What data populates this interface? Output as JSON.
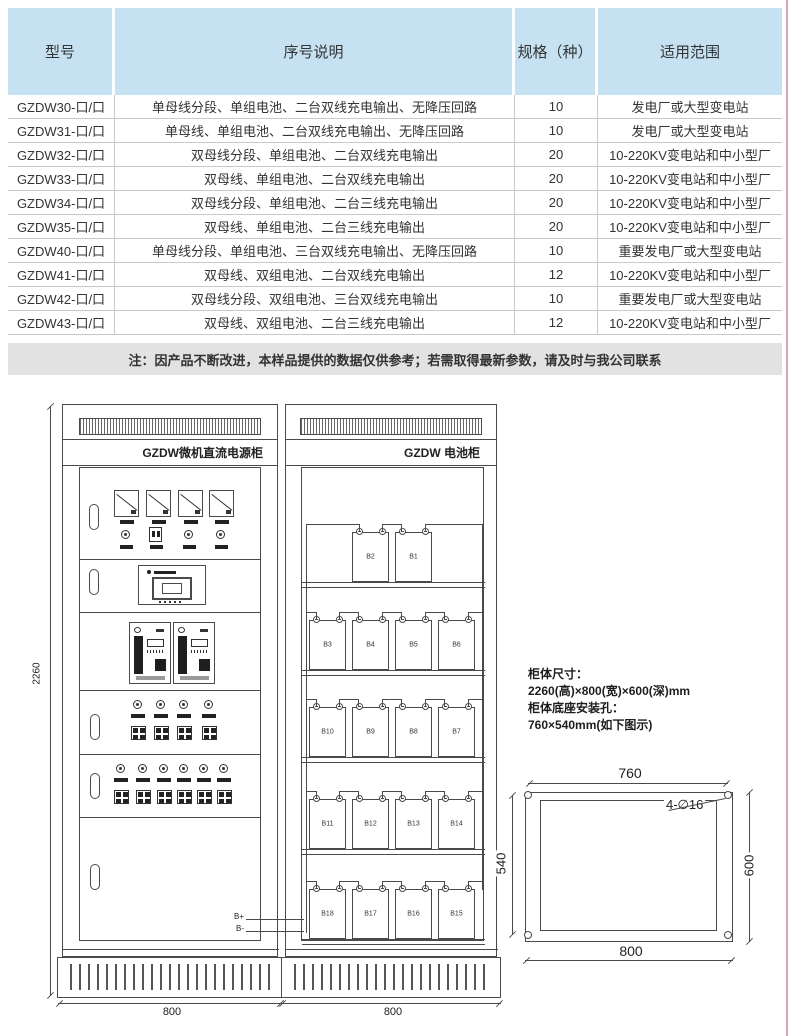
{
  "colors": {
    "table_header_bg": "#c6e2f2",
    "note_bg": "#e2e2e2",
    "page_edge_line": "#d4a7ba",
    "drawing_line": "#4a4a4a"
  },
  "table": {
    "headers": [
      "型号",
      "序号说明",
      "规格（种）",
      "适用范围"
    ],
    "rows": [
      {
        "model": "GZDW30-口/口",
        "desc": "单母线分段、单组电池、二台双线充电输出、无降压回路",
        "spec": "10",
        "range": "发电厂或大型变电站"
      },
      {
        "model": "GZDW31-口/口",
        "desc": "单母线、单组电池、二台双线充电输出、无降压回路",
        "spec": "10",
        "range": "发电厂或大型变电站"
      },
      {
        "model": "GZDW32-口/口",
        "desc": "双母线分段、单组电池、二台双线充电输出",
        "spec": "20",
        "range": "10-220KV变电站和中小型厂"
      },
      {
        "model": "GZDW33-口/口",
        "desc": "双母线、单组电池、二台双线充电输出",
        "spec": "20",
        "range": "10-220KV变电站和中小型厂"
      },
      {
        "model": "GZDW34-口/口",
        "desc": "双母线分段、单组电池、二台三线充电输出",
        "spec": "20",
        "range": "10-220KV变电站和中小型厂"
      },
      {
        "model": "GZDW35-口/口",
        "desc": "双母线、单组电池、二台三线充电输出",
        "spec": "20",
        "range": "10-220KV变电站和中小型厂"
      },
      {
        "model": "GZDW40-口/口",
        "desc": "单母线分段、单组电池、三台双线充电输出、无降压回路",
        "spec": "10",
        "range": "重要发电厂或大型变电站"
      },
      {
        "model": "GZDW41-口/口",
        "desc": "双母线、双组电池、二台双线充电输出",
        "spec": "12",
        "range": "10-220KV变电站和中小型厂"
      },
      {
        "model": "GZDW42-口/口",
        "desc": "双母线分段、双组电池、三台双线充电输出",
        "spec": "10",
        "range": "重要发电厂或大型变电站"
      },
      {
        "model": "GZDW43-口/口",
        "desc": "双母线、双组电池、二台三线充电输出",
        "spec": "12",
        "range": "10-220KV变电站和中小型厂"
      }
    ]
  },
  "note": "注：因产品不断改进，本样品提供的数据仅供参考；若需取得最新参数，请及时与我公司联系",
  "power_cabinet": {
    "title": "GZDW微机直流电源柜",
    "meter_count": 4,
    "indicator_count": 4,
    "breaker_rows": [
      4,
      6
    ],
    "b_plus": "B+",
    "b_minus": "B-",
    "height_label": "2260",
    "width_label": "800"
  },
  "battery_cabinet": {
    "title": "GZDW 电池柜",
    "shelves": [
      [
        "B2",
        "B1"
      ],
      [
        "B3",
        "B4",
        "B5",
        "B6"
      ],
      [
        "B10",
        "B9",
        "B8",
        "B7"
      ],
      [
        "B11",
        "B12",
        "B13",
        "B14"
      ],
      [
        "B18",
        "B17",
        "B16",
        "B15"
      ]
    ],
    "width_label": "800"
  },
  "info_block": {
    "lines": [
      "柜体尺寸：",
      "2260(高)×800(宽)×600(深)mm",
      "柜体底座安装孔：",
      "760×540mm(如下图示)"
    ]
  },
  "mounting": {
    "holes_label": "4-∅16",
    "top": "760",
    "left": "540",
    "right": "600",
    "bottom": "800"
  }
}
